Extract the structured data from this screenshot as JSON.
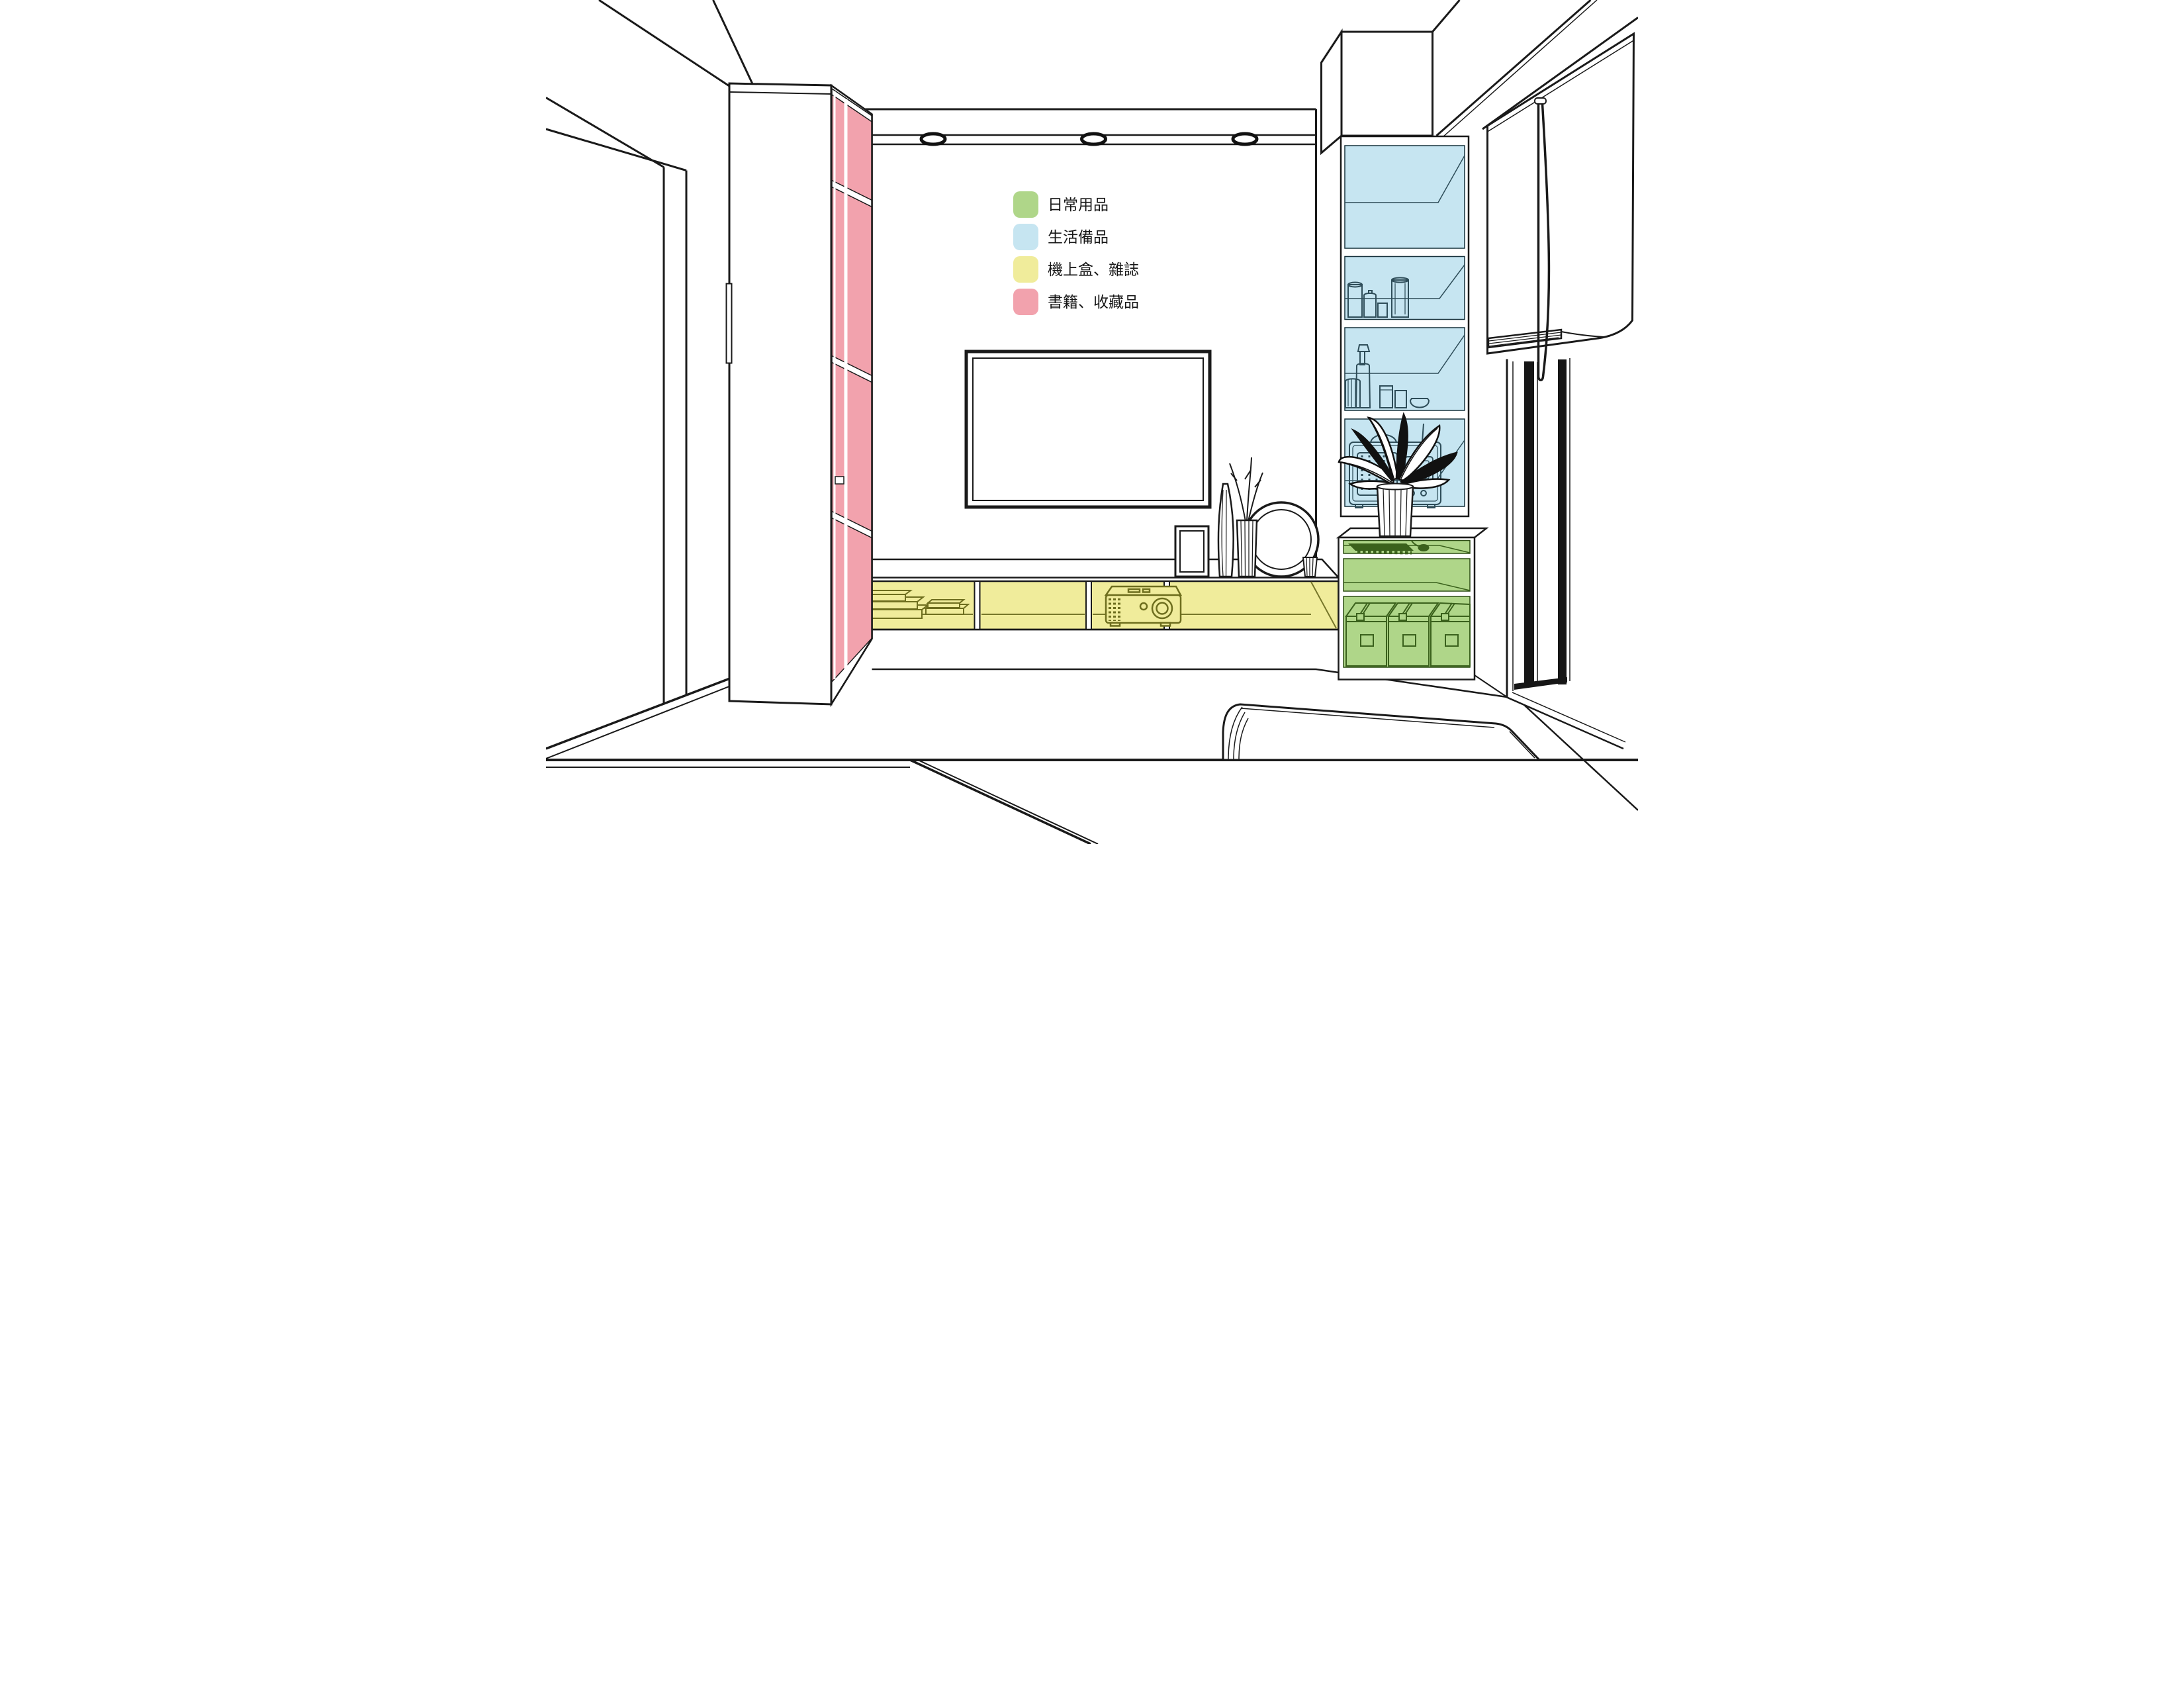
{
  "legend": {
    "items": [
      {
        "id": "daily-necessities",
        "label": "日常用品",
        "color": "#AFD689"
      },
      {
        "id": "living-supplies",
        "label": "生活備品",
        "color": "#C6E5F1"
      },
      {
        "id": "settop-box-magazines",
        "label": "機上盒、雜誌",
        "color": "#F0EC9B"
      },
      {
        "id": "books-collectibles",
        "label": "書籍、收藏品",
        "color": "#F2A2AD"
      }
    ]
  }
}
